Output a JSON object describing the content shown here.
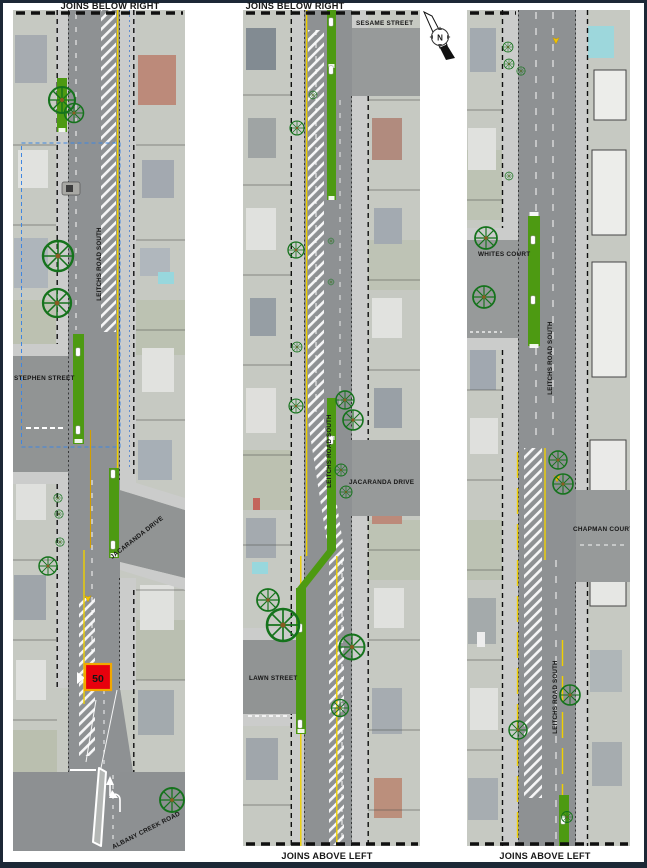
{
  "panel1": {
    "top_label": "JOINS BELOW RIGHT",
    "road_label": "LEITCHS ROAD SOUTH",
    "stephen_street": "STEPHEN STREET",
    "jacaranda_drive": "JACARANDA DRIVE",
    "albany_creek_road": "ALBANY CREEK ROAD",
    "speed_limit": "50"
  },
  "panel2": {
    "top_label": "JOINS BELOW RIGHT",
    "bottom_label": "JOINS ABOVE LEFT",
    "sesame_street": "SESAME STREET",
    "road_label": "LEITCHS ROAD SOUTH",
    "jacaranda_drive": "JACARANDA DRIVE",
    "lawn_street": "LAWN STREET"
  },
  "panel3": {
    "bottom_label": "JOINS ABOVE LEFT",
    "whites_court": "WHITES COURT",
    "road_label_upper": "LEITCHS ROAD SOUTH",
    "chapman_court": "CHAPMAN COURT",
    "road_label_lower": "LEITCHS ROAD SOUTH"
  },
  "north_arrow": {
    "label": "N"
  },
  "colors": {
    "page_border": "#1c2836",
    "median_green": "#4d9a12",
    "edge_line_yellow": "#f0d000",
    "speed_sign_red": "#e8000d",
    "speed_sign_border": "#f2a800",
    "survey_extent_blue": "#3f86e0",
    "tree_green": "#15731c"
  }
}
